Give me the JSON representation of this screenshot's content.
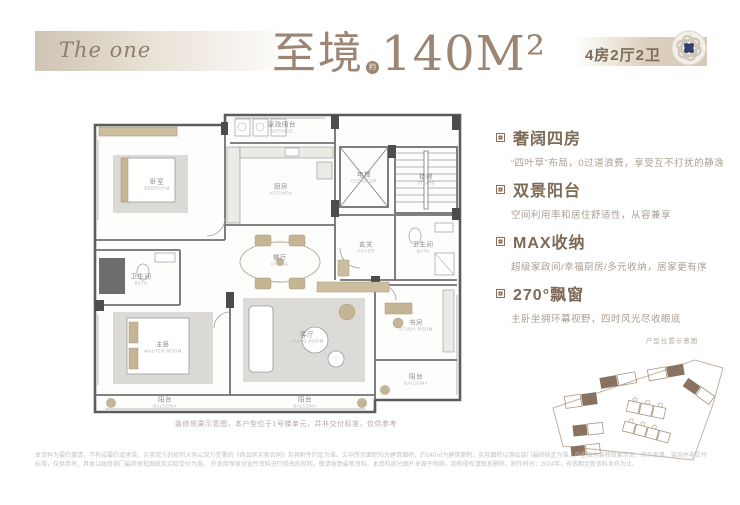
{
  "header": {
    "brand": "The one",
    "title": "至境",
    "approx": "约",
    "area": "140M²",
    "badge": "4房2厅2卫",
    "accent_color": "#9c8673",
    "logo_navy": "#32406b",
    "bar_beige": "#d7cab7"
  },
  "features": [
    {
      "title": "奢阔四房",
      "desc": "“四叶草”布局，0过道浪费，享受互不打扰的静逸"
    },
    {
      "title": "双景阳台",
      "desc": "空间利用率和居住舒适性，从容兼享"
    },
    {
      "title": "MAX收纳",
      "desc": "超级家政间/幸福厨房/多元收纳，居家更有序"
    },
    {
      "title": "270°飘窗",
      "desc": "主卧坐拥环幕视野，四时风光尽收眼底"
    }
  ],
  "floorplan": {
    "rooms": [
      {
        "label": "卧室",
        "en": "BEDROOM"
      },
      {
        "label": "家政阳台",
        "en": "SERVICE"
      },
      {
        "label": "厨房",
        "en": "KITCHEN"
      },
      {
        "label": "电梯",
        "en": "ELEVATOR"
      },
      {
        "label": "楼梯",
        "en": "STAIRS"
      },
      {
        "label": "玄关",
        "en": "FOYER"
      },
      {
        "label": "卫生间",
        "en": "BATH"
      },
      {
        "label": "餐厅",
        "en": "DINING"
      },
      {
        "label": "卫生间",
        "en": "BATH"
      },
      {
        "label": "主卧",
        "en": "MASTER ROOM"
      },
      {
        "label": "客厅",
        "en": "LIVING ROOM"
      },
      {
        "label": "书房",
        "en": "STUDY ROOM"
      },
      {
        "label": "阳台",
        "en": "BALCONY"
      },
      {
        "label": "阳台",
        "en": "BALCONY"
      },
      {
        "label": "阳台",
        "en": "BALCONY"
      }
    ]
  },
  "siteplan": {
    "label": "户型位置示意图"
  },
  "caption": "装修效果示意图，本户型位于1号楼单元，并非交付标准，仅供参考",
  "disclaimer": {
    "line1": "本资料为要约邀请，不构成要约或承诺，买卖双方的权利义务以双方签署的《商品房买卖合同》及其附件约定为准。文中所示面积均为建筑面积，约140㎡为建筑面积，实际面积以测绘部门最终核定为准。户型图为装修效果示意，所示家具、装饰并非交付标准，仅供参考，具体以政府部门最终审批图纸及实际交付为准。",
    "line2": "开发商保留对宣传资料进行修改的权利，敬请留意最新资料。本资料部分图片来源于网络，如有侵权请联系删除。制作时间：2024年，有效期至新资料发布为止。"
  }
}
